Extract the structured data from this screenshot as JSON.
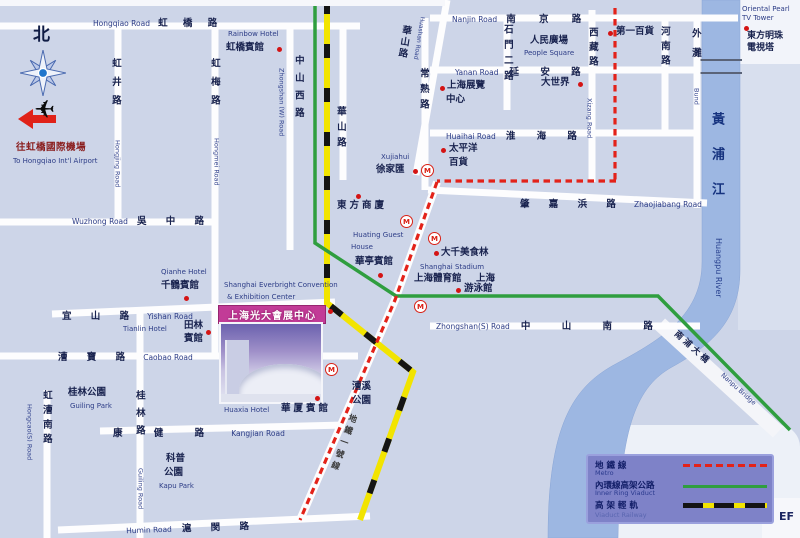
{
  "colors": {
    "background": "#cdd5e8",
    "road": "#fdfdfe",
    "river": "#9db7e2",
    "metro_red": "#e32219",
    "ring_green": "#2f9e3f",
    "rail_yellow": "#f2e400",
    "rail_black": "#141414",
    "legend_bg": "#7e82c8",
    "banner_magenta": "#c23b97",
    "marker_red": "#d41414"
  },
  "compass_north": "北",
  "airport": {
    "zh": "往虹橋國際機場",
    "en": "To Hongqiao Int'l Airport"
  },
  "roads": {
    "hongqiao": {
      "en": "Hongqiao Road",
      "zh": "虹 橋 路"
    },
    "wuzhong": {
      "en": "Wuzhong Road",
      "zh": "吳 中 路"
    },
    "yishan": {
      "zh": "宜 山 路",
      "en": "Yishan Road"
    },
    "caobao": {
      "zh": "漕 寶 路",
      "en": "Caobao Road"
    },
    "kangjian": {
      "zh": "康 健 路",
      "en": "Kangjian Road"
    },
    "humin": {
      "en": "Humin Road",
      "zh": "滬 閔 路"
    },
    "nanjing": {
      "en": "Nanjin Road",
      "zh": "南 京 路"
    },
    "yanan": {
      "en": "Yanan Road",
      "zh": "延 安 路"
    },
    "huaihai": {
      "en": "Huaihai Road",
      "zh": "淮 海 路"
    },
    "zhaojiabang": {
      "zh": "肇 嘉 浜 路",
      "en": "Zhaojiabang Road"
    },
    "zhongshan_s": {
      "en": "Zhongshan(S) Road",
      "zh": "中 山 南 路"
    },
    "hongjing": {
      "zh": "虹井路",
      "en": "Hongjing Road"
    },
    "hongmei": {
      "zh": "虹梅路",
      "en": "Hongmei Road"
    },
    "zhongshan_w": {
      "zh": "中山西路",
      "en": "Zhongshan (W) Road"
    },
    "huashan_v": {
      "zh": "華山路"
    },
    "huashan_diag": {
      "zh": "華山路",
      "en": "Huashan Road"
    },
    "changshu": {
      "zh": "常熟路"
    },
    "shimen": {
      "zh": "石門二路"
    },
    "xizang": {
      "zh": "西藏路",
      "en": "Xizang Road"
    },
    "henan": {
      "zh": "河南路"
    },
    "bund": {
      "zh": "外灘",
      "en": "Bund"
    },
    "hongcao_s": {
      "zh": "虹漕南路",
      "en": "Hongcao(S) Road"
    },
    "guilin_rd": {
      "zh": "桂林路",
      "en": "Guiling Road"
    },
    "metro1": {
      "zh": "地鐵一號線"
    }
  },
  "places": {
    "rainbow_hotel": {
      "en": "Rainbow Hotel",
      "zh": "虹橋賓館"
    },
    "qianhe_hotel": {
      "en": "Qianhe Hotel",
      "zh": "千鶴賓館"
    },
    "tianlin_hotel": {
      "en": "Tianlin Hotel",
      "zh1": "田林",
      "zh2": "賓館"
    },
    "huaxia_hotel": {
      "en": "Huaxia Hotel",
      "zh": "華厦賓館"
    },
    "huating": {
      "en1": "Huating Guest",
      "en2": "House",
      "zh": "華亭賓館"
    },
    "dongfang_store": {
      "zh": "東方商廈"
    },
    "xujiahui": {
      "en": "Xujiahui",
      "zh": "徐家匯"
    },
    "pacific": {
      "zh1": "太平洋",
      "zh2": "百貨"
    },
    "daqian": {
      "zh": "大千美食林"
    },
    "stadium": {
      "en": "Shanghai Stadium",
      "zh1": "上海體育館",
      "zh2": "上海",
      "zh3": "游泳館"
    },
    "exhibition_center": {
      "zh1": "上海展覽",
      "zh2": "中心"
    },
    "great_world": {
      "zh": "大世界"
    },
    "people_square": {
      "zh": "人民廣場",
      "en": "People Square"
    },
    "no1_store": {
      "zh": "第一百貨"
    },
    "pearl_tower": {
      "en1": "Oriental Pearl",
      "en2": "TV Tower",
      "zh1": "東方明珠",
      "zh2": "電視塔"
    },
    "guilin_park": {
      "zh": "桂林公園",
      "en": "Guiling Park"
    },
    "kapu_park": {
      "zh1": "科普",
      "zh2": "公園",
      "en": "Kapu Park"
    },
    "caoxi_park": {
      "zh1": "漕溪",
      "zh2": "公園"
    },
    "river": {
      "zh": "黃浦江",
      "en": "Huangpu River"
    },
    "nanpu_bridge": {
      "zh": "南浦大橋",
      "en": "Nanpu Bridge"
    }
  },
  "center": {
    "en1": "Shanghai Everbright Convention",
    "en2": "& Exhibition Center",
    "banner": "上海光大會展中心"
  },
  "legend": {
    "rows": [
      {
        "zh": "地 鐵 線",
        "en": "Metro"
      },
      {
        "zh": "內環線高架公路",
        "en": "Inner Ring Viaduct"
      },
      {
        "zh": "高 架 輕 軌",
        "en": "Viaduct Railway"
      }
    ]
  },
  "station_letter": "M",
  "corner_text": "EF"
}
